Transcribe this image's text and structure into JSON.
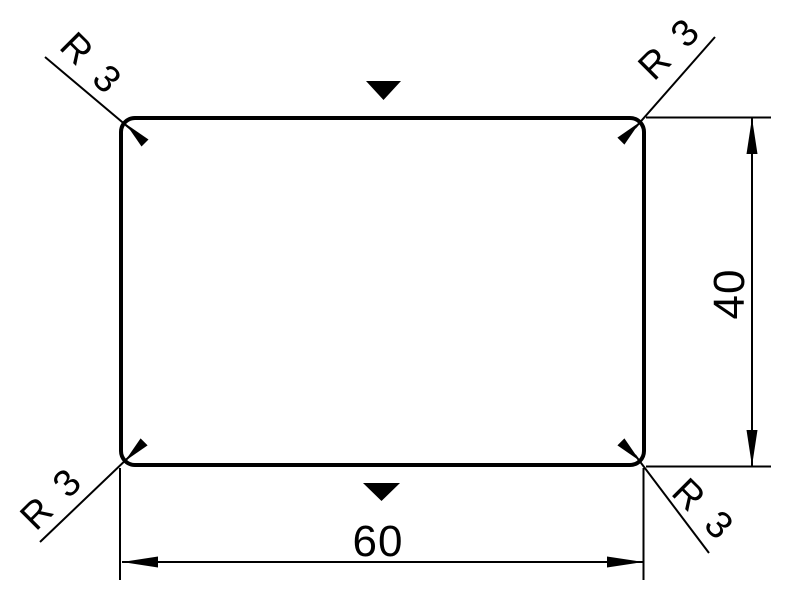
{
  "drawing": {
    "type": "technical-drawing",
    "shape": "rounded-rectangle",
    "background_color": "#ffffff",
    "line_color": "#000000",
    "width_dimension": {
      "value": "60"
    },
    "height_dimension": {
      "value": "40"
    },
    "radius_callouts": {
      "top_left": "R 3",
      "top_right": "R 3",
      "bottom_left": "R 3",
      "bottom_right": "R 3"
    },
    "markers": {
      "top": "filled-triangle-down",
      "bottom": "filled-triangle-down"
    }
  }
}
